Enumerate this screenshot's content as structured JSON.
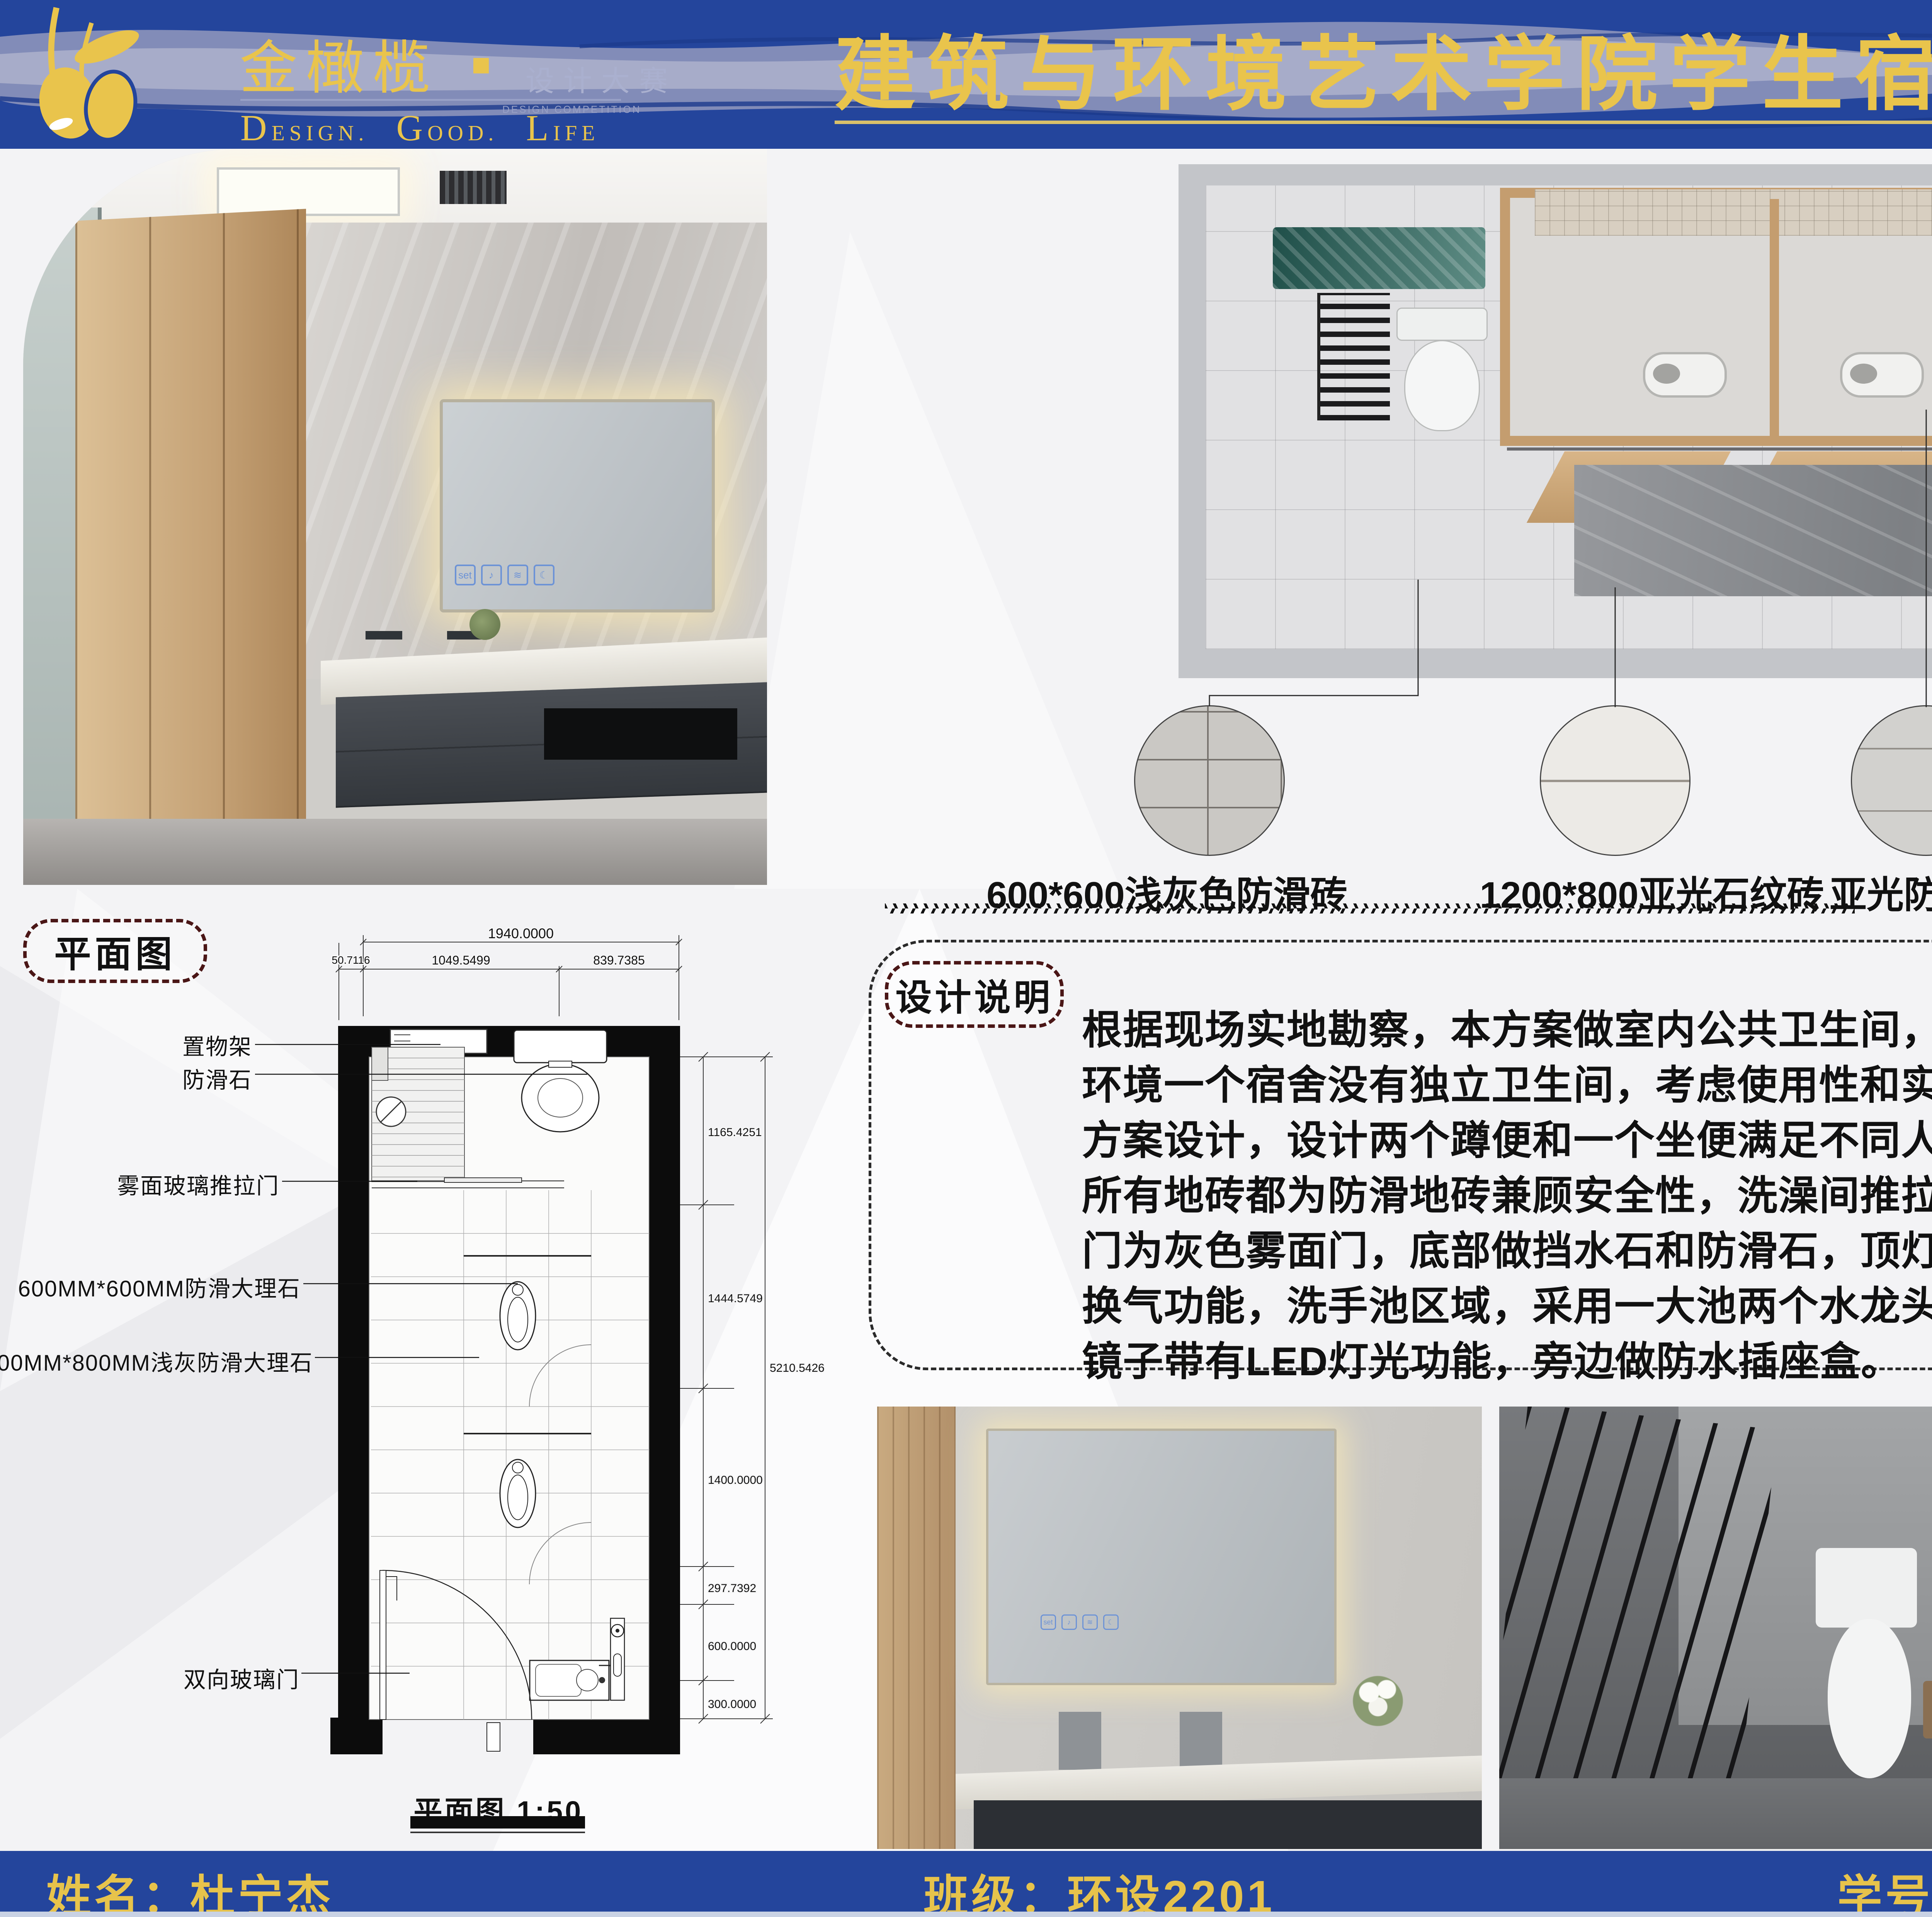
{
  "colors": {
    "primary_blue": "#24459c",
    "accent_yellow": "#e9c44c",
    "underline_gold": "#d9c06a",
    "wave_lavender": "#8d93bb",
    "dashed_maroon": "#4a1616",
    "wood_tone": "#c69f72",
    "teal_accent": "#2e5f58",
    "mirror_icon_blue": "#6d93d6",
    "swatch_hex": [
      "#cac8c4",
      "#eceae6",
      "#d2d1ce",
      "#cda775",
      "#8f9092"
    ]
  },
  "header": {
    "brand": "金橄榄",
    "brand_dot": "",
    "brand_sub": "设计大赛",
    "brand_sub_en": "DESIGN COMPETITION",
    "tagline": [
      {
        "cap": "D",
        "rest": "ESIGN."
      },
      {
        "cap": "G",
        "rest": "OOD."
      },
      {
        "cap": "L",
        "rest": "IFE"
      }
    ],
    "title": "建筑与环境艺术学院学生宿舍卫生间设计大赛"
  },
  "materials": {
    "items": [
      {
        "label": "600*600浅灰色防滑砖"
      },
      {
        "label": "1200*800亚光石纹砖"
      },
      {
        "label": "亚光防滑砖"
      },
      {
        "label": "亚光浅黄色胶合板"
      },
      {
        "label": "亮面中灰色防滑"
      }
    ]
  },
  "plan": {
    "tag": "平面图",
    "caption": "平面图  1:50",
    "labels": {
      "shelf": "置物架",
      "antislip": "防滑石",
      "sliding_door": "雾面玻璃推拉门",
      "marble600": "600MM*600MM防滑大理石",
      "marble1200": "1200MM*800MM浅灰防滑大理石",
      "double_door": "双向玻璃门"
    },
    "dims": {
      "total_width": "1940.0000",
      "seg_left": "50.7116",
      "seg_mid": "1049.5499",
      "seg_right": "839.7385",
      "right_1": "1165.4251",
      "right_2": "1444.5749",
      "right_total": "5210.5426",
      "right_3": "1400.0000",
      "right_4": "297.7392",
      "right_5": "600.0000",
      "right_6": "300.0000"
    }
  },
  "description": {
    "tag": "设计说明",
    "lines": [
      "根据现场实地勘察，本方案做室内公共卫生间，考虑现场",
      "环境一个宿舍没有独立卫生间，考虑使用性和实用性做本",
      "方案设计，设计两个蹲便和一个坐便满足不同人群需求，",
      "所有地砖都为防滑地砖兼顾安全性，洗澡间推拉门设计，",
      "门为灰色雾面门，底部做挡水石和防滑石，顶灯有1通风",
      "换气功能，洗手池区域，采用一大池两个水龙头节约空间",
      "镜子带有LED灯光功能，旁边做防水插座盒。"
    ]
  },
  "mirror": {
    "set_label": "set",
    "icons": [
      "♪",
      "≋",
      "☾"
    ]
  },
  "footer": {
    "name": "姓名：杜宁杰",
    "class": "班级：环设2201",
    "student_id": "学号：202240020"
  }
}
